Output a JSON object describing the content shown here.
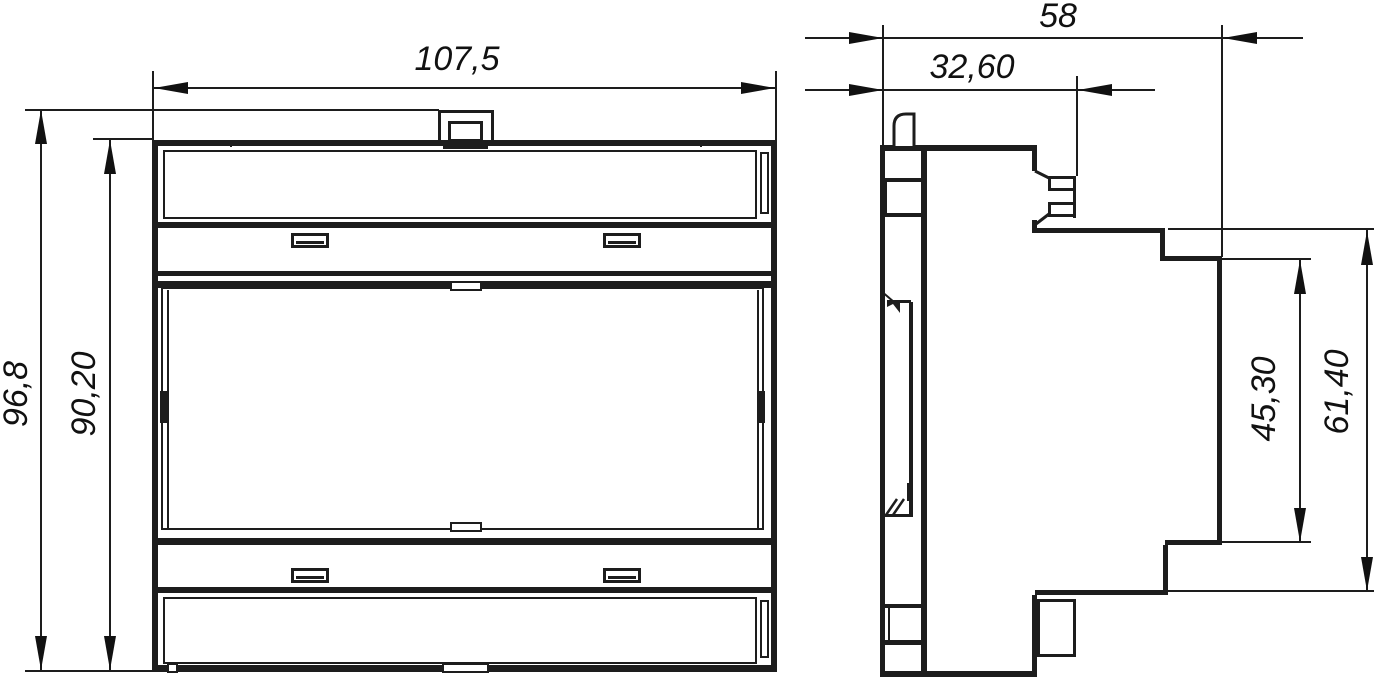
{
  "drawing_type": "technical-dimension-drawing",
  "colors": {
    "line": "#1d1d1d",
    "background": "#ffffff"
  },
  "front_view": {
    "width": "107,5",
    "overall_height": "96,8",
    "body_height": "90,20"
  },
  "side_view": {
    "overall_depth": "58",
    "rear_block_depth": "32,60",
    "front_panel_height": "45,30",
    "front_section_height": "61,40"
  }
}
